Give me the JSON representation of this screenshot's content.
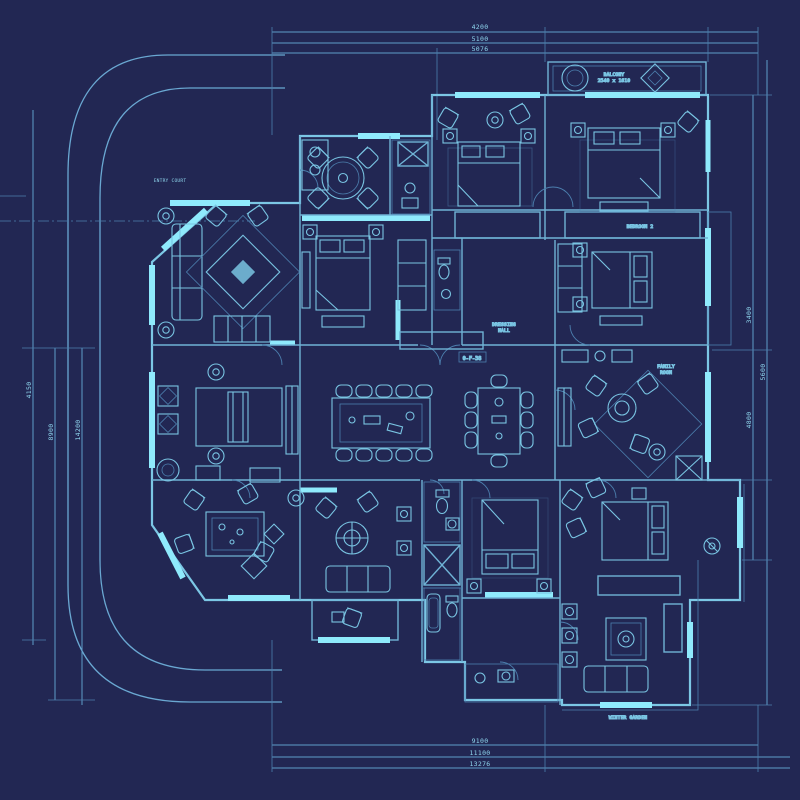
{
  "title": "apartment-floor-plan-blueprint",
  "colors": {
    "background": "#222753",
    "wall_line": "#7cc7e5",
    "interior_line": "#6fb3d6",
    "faint_line": "#4c7fae",
    "highlight_wall": "#8feafc",
    "dimension_line": "#5f9cc8",
    "text": "#8fd6ee"
  },
  "dims": {
    "top": [
      "4200",
      "5100",
      "5076"
    ],
    "bottom": [
      "9100",
      "11100",
      "13276"
    ],
    "left": [
      "4150",
      "8900",
      "14200"
    ],
    "right": [
      "3400",
      "5600",
      "4800"
    ]
  },
  "labels": {
    "site_note": "ENTRY COURT",
    "balcony_line1": "BALCONY",
    "balcony_line2": "2540 x 1610",
    "hall_line1": "DRESSING",
    "hall_line2": "HALL",
    "hall_code": "0-F-38",
    "bedroom_right": "BEDROOM 2",
    "family_line1": "FAMILY",
    "family_line2": "ROOM",
    "terrace": "WINTER GARDEN"
  }
}
